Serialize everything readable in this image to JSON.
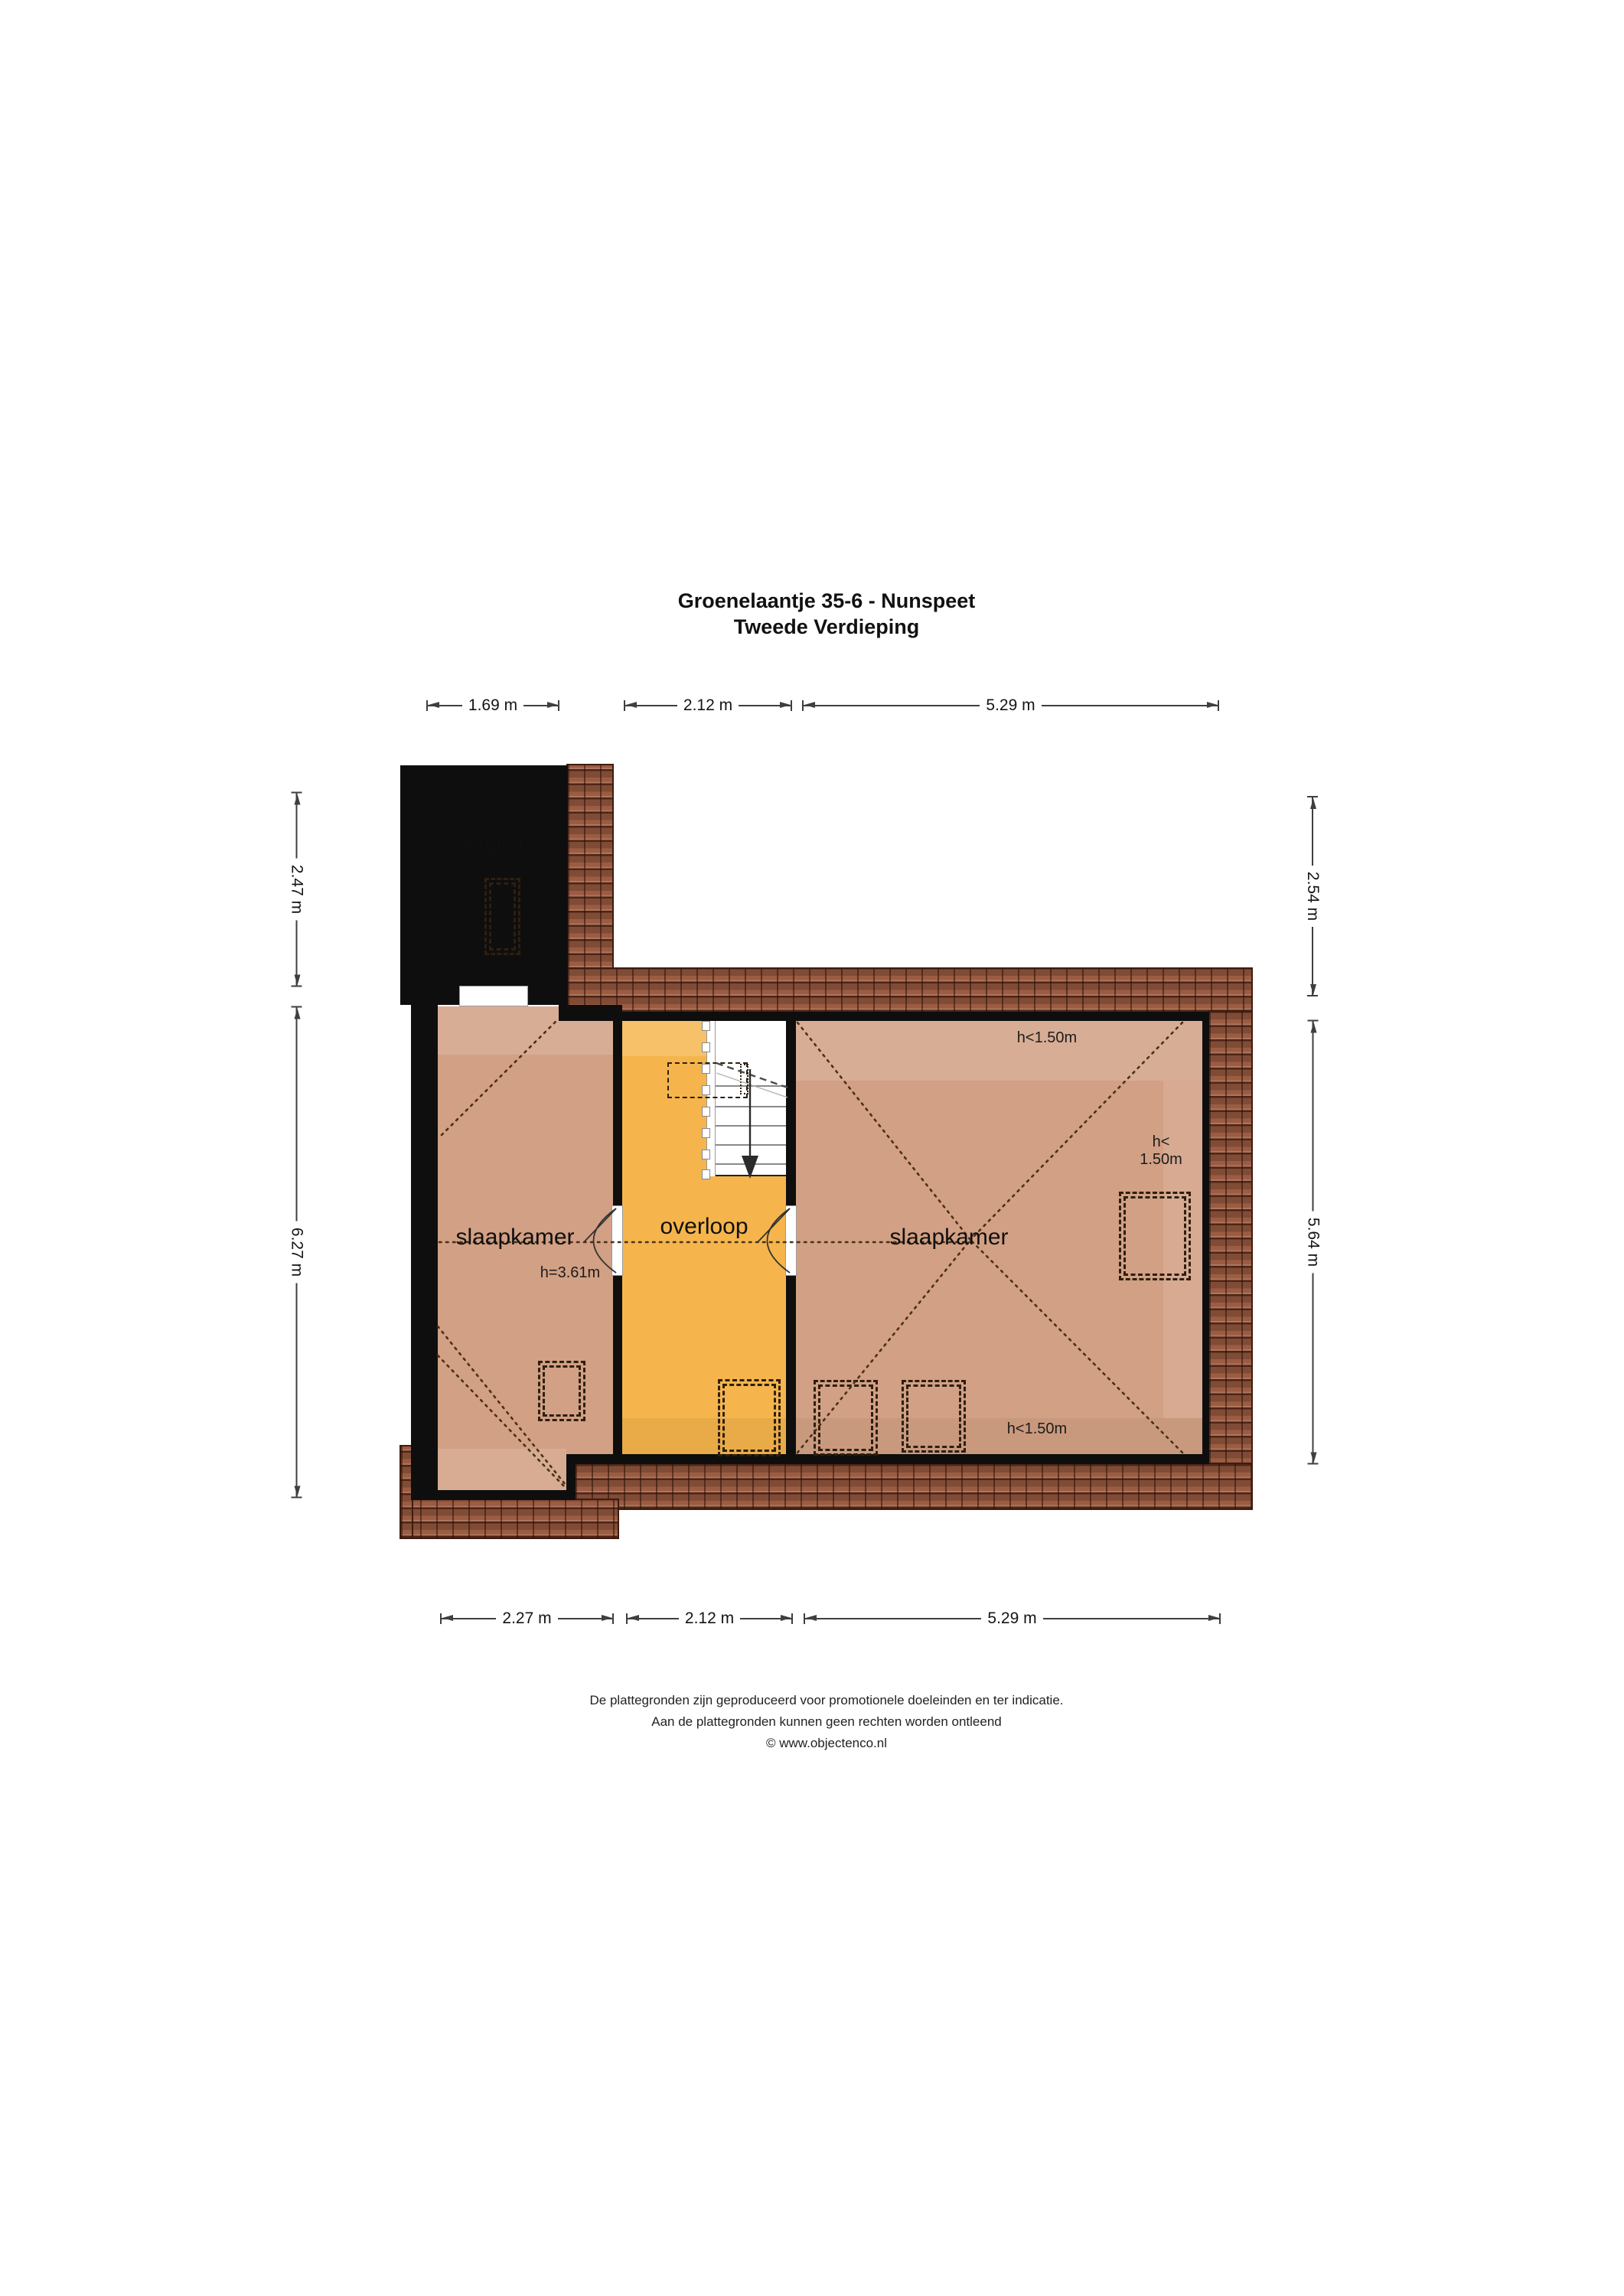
{
  "page_title": "Groenelaantje 35-6 - Nunspeet",
  "page_subtitle": "Tweede Verdieping",
  "rooms": {
    "berging": {
      "label": "berging"
    },
    "bedroom_left": {
      "label": "slaapkamer",
      "height_note": "h=3.61m"
    },
    "landing": {
      "label": "overloop"
    },
    "bedroom_right": {
      "label": "slaapkamer",
      "height_note_top": "h<1.50m",
      "height_note_bottom": "h<1.50m",
      "height_note_right_line1": "h<",
      "height_note_right_line2": "1.50m"
    }
  },
  "dimensions": {
    "top": [
      "1.69 m",
      "2.12 m",
      "5.29 m"
    ],
    "bottom": [
      "2.27 m",
      "2.12 m",
      "5.29 m"
    ],
    "left": [
      "2.47 m",
      "6.27 m"
    ],
    "right": [
      "2.54 m",
      "5.64 m"
    ]
  },
  "footer": {
    "line1": "De plattegronden zijn geproduceerd voor promotionele doeleinden en ter indicatie.",
    "line2": "Aan de plattegronden kunnen geen rechten worden ontleend",
    "line3": "© www.objectenco.nl"
  },
  "colors": {
    "wall": "#0e0e0e",
    "berging_floor": "#eae4d2",
    "bedroom_floor": "#d2a084",
    "landing_floor": "#f5b54c",
    "roof_tiles": "#9c5c42"
  }
}
